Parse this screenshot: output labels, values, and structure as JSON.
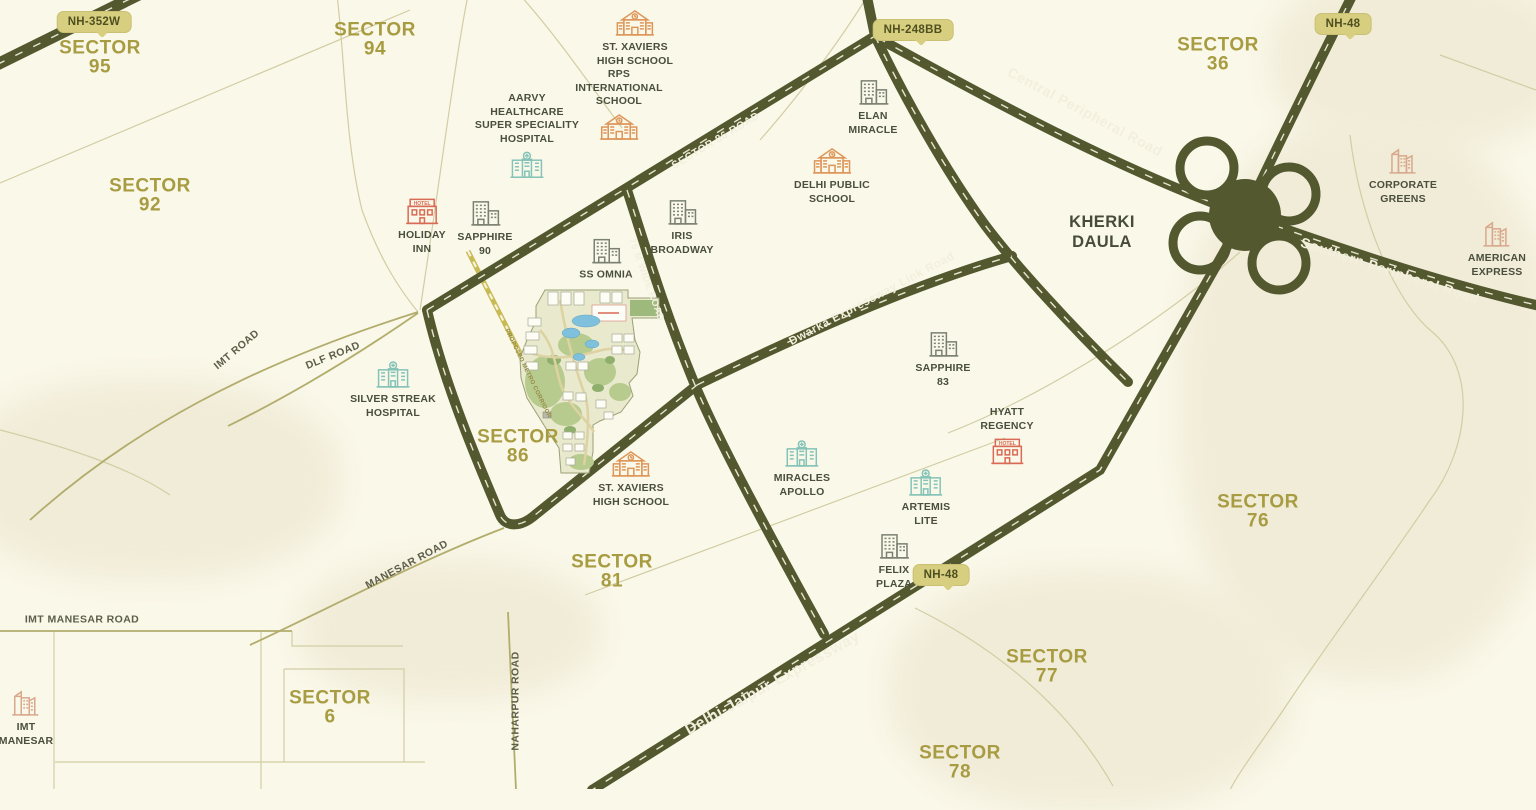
{
  "title": "Location map - Sector 86 Gurugram vicinity",
  "colors": {
    "background": "#faf8e9",
    "terrain_patch": "#f1ecd8",
    "road_dark": "#53582f",
    "road_dash": "#f0edd8",
    "road_thin": "#b2ad6c",
    "boundary": "#d2cda4",
    "proposed_road": "#c8ba55",
    "badge_bg": "#d7ce7f",
    "badge_text": "#4f5020",
    "sector_text": "#a89c42",
    "landmark_text": "#4a4f3d",
    "area_text": "#474c39",
    "road_label_text": "#f2efdd",
    "icon_school": "#dd9659",
    "icon_hospital": "#85c3b8",
    "icon_towers": "#7b8171",
    "icon_corporate": "#d8a88c",
    "icon_hotel": "#d96a55",
    "water": "#7fc0dc",
    "site_green": "#b8cb8e"
  },
  "highway_badges": [
    {
      "label": "NH-352W",
      "x": 94,
      "y": 22
    },
    {
      "label": "NH-248BB",
      "x": 913,
      "y": 30
    },
    {
      "label": "NH-48",
      "x": 1343,
      "y": 24
    },
    {
      "label": "NH-48",
      "x": 941,
      "y": 575
    }
  ],
  "sectors": [
    {
      "word": "SECTOR",
      "number": "95",
      "x": 100,
      "y": 58
    },
    {
      "word": "SECTOR",
      "number": "94",
      "x": 375,
      "y": 40
    },
    {
      "word": "SECTOR",
      "number": "92",
      "x": 150,
      "y": 196
    },
    {
      "word": "SECTOR",
      "number": "36",
      "x": 1218,
      "y": 55
    },
    {
      "word": "SECTOR",
      "number": "86",
      "x": 518,
      "y": 447
    },
    {
      "word": "SECTOR",
      "number": "81",
      "x": 612,
      "y": 572
    },
    {
      "word": "SECTOR",
      "number": "76",
      "x": 1258,
      "y": 512
    },
    {
      "word": "SECTOR",
      "number": "77",
      "x": 1047,
      "y": 667
    },
    {
      "word": "SECTOR",
      "number": "78",
      "x": 960,
      "y": 763
    },
    {
      "word": "SECTOR",
      "number": "6",
      "x": 330,
      "y": 708
    }
  ],
  "area_labels": [
    {
      "text": "KHERKI\nDAULA",
      "x": 1102,
      "y": 232
    }
  ],
  "road_labels": [
    {
      "text": "Central Peripheral Road",
      "x": 1085,
      "y": 112,
      "angle": 28,
      "size": 14,
      "kind": "major"
    },
    {
      "text": "Southern Peripheral Road",
      "x": 1390,
      "y": 271,
      "angle": 18,
      "size": 14,
      "kind": "major"
    },
    {
      "text": "Delhi-Jaipur Expressway",
      "x": 773,
      "y": 684,
      "angle": -29,
      "size": 15.5,
      "kind": "major"
    },
    {
      "text": "Dwarka Expressway Link Road",
      "x": 872,
      "y": 299,
      "angle": -28,
      "size": 11.5,
      "kind": "major"
    },
    {
      "text": "SECTOR 86 ROAD",
      "x": 716,
      "y": 141,
      "angle": -31,
      "size": 10.5,
      "kind": "major"
    },
    {
      "text": "75 M WIDE ROAD",
      "x": 646,
      "y": 280,
      "angle": 70,
      "size": 9.5,
      "kind": "major"
    },
    {
      "text": "IMT ROAD",
      "x": 237,
      "y": 350,
      "angle": -40,
      "size": 10.5,
      "kind": "minor"
    },
    {
      "text": "DLF ROAD",
      "x": 333,
      "y": 356,
      "angle": -22,
      "size": 10.5,
      "kind": "minor"
    },
    {
      "text": "MANESAR ROAD",
      "x": 407,
      "y": 565,
      "angle": -28,
      "size": 10.5,
      "kind": "minor"
    },
    {
      "text": "IMT MANESAR ROAD",
      "x": 82,
      "y": 620,
      "angle": 0,
      "size": 10.5,
      "kind": "minor"
    },
    {
      "text": "NAHARPUR ROAD",
      "x": 516,
      "y": 701,
      "angle": -90,
      "size": 10.5,
      "kind": "minor"
    },
    {
      "text": "PROPOSED METRO CORRIDOR",
      "x": 527,
      "y": 374,
      "angle": 64,
      "size": 6,
      "kind": "proposed"
    }
  ],
  "landmarks": [
    {
      "id": "st-xaviers-high-school-top",
      "label": "ST. XAVIERS\nHIGH SCHOOL",
      "icon": "school",
      "x": 635,
      "y": 38,
      "text_first": false
    },
    {
      "id": "rps-international-school",
      "label": "RPS\nINTERNATIONAL\nSCHOOL",
      "icon": "school",
      "x": 619,
      "y": 105,
      "text_first": true
    },
    {
      "id": "aarvy-healthcare-hospital",
      "label": "AARVY\nHEALTHCARE\nSUPER SPECIALITY\nHOSPITAL",
      "icon": "hospital",
      "x": 527,
      "y": 136,
      "text_first": true
    },
    {
      "id": "elan-miracle",
      "label": "ELAN\nMIRACLE",
      "icon": "towers",
      "x": 873,
      "y": 107,
      "text_first": false
    },
    {
      "id": "delhi-public-school",
      "label": "DELHI PUBLIC\nSCHOOL",
      "icon": "school",
      "x": 832,
      "y": 176,
      "text_first": false
    },
    {
      "id": "holiday-inn",
      "label": "HOLIDAY\nINN",
      "icon": "hotel",
      "x": 422,
      "y": 226,
      "text_first": false
    },
    {
      "id": "sapphire-90",
      "label": "SAPPHIRE\n90",
      "icon": "towers",
      "x": 485,
      "y": 228,
      "text_first": false
    },
    {
      "id": "iris-broadway",
      "label": "IRIS\nBROADWAY",
      "icon": "towers",
      "x": 682,
      "y": 227,
      "text_first": false
    },
    {
      "id": "ss-omnia",
      "label": "SS OMNIA",
      "icon": "towers",
      "x": 606,
      "y": 259,
      "text_first": false
    },
    {
      "id": "corporate-greens",
      "label": "CORPORATE\nGREENS",
      "icon": "corporate",
      "x": 1403,
      "y": 176,
      "text_first": false
    },
    {
      "id": "american-express",
      "label": "AMERICAN\nEXPRESS",
      "icon": "corporate",
      "x": 1497,
      "y": 249,
      "text_first": false
    },
    {
      "id": "silver-streak-hospital",
      "label": "SILVER STREAK\nHOSPITAL",
      "icon": "hospital",
      "x": 393,
      "y": 390,
      "text_first": false
    },
    {
      "id": "sapphire-83",
      "label": "SAPPHIRE\n83",
      "icon": "towers",
      "x": 943,
      "y": 359,
      "text_first": false
    },
    {
      "id": "hyatt-regency",
      "label": "HYATT\nREGENCY",
      "icon": "hotel",
      "x": 1007,
      "y": 436,
      "text_first": true
    },
    {
      "id": "st-xaviers-high-school-bottom",
      "label": "ST. XAVIERS\nHIGH SCHOOL",
      "icon": "school",
      "x": 631,
      "y": 479,
      "text_first": false
    },
    {
      "id": "miracles-apollo",
      "label": "MIRACLES\nAPOLLO",
      "icon": "hospital",
      "x": 802,
      "y": 469,
      "text_first": false
    },
    {
      "id": "artemis-lite",
      "label": "ARTEMIS\nLITE",
      "icon": "hospital",
      "x": 926,
      "y": 498,
      "text_first": false
    },
    {
      "id": "felix-plaza",
      "label": "FELIX\nPLAZA",
      "icon": "towers",
      "x": 894,
      "y": 561,
      "text_first": false
    },
    {
      "id": "imt-manesar",
      "label": "IMT\nMANESAR",
      "icon": "corporate",
      "x": 26,
      "y": 718,
      "text_first": false
    }
  ],
  "hotel_sign_text": "HOTEL"
}
